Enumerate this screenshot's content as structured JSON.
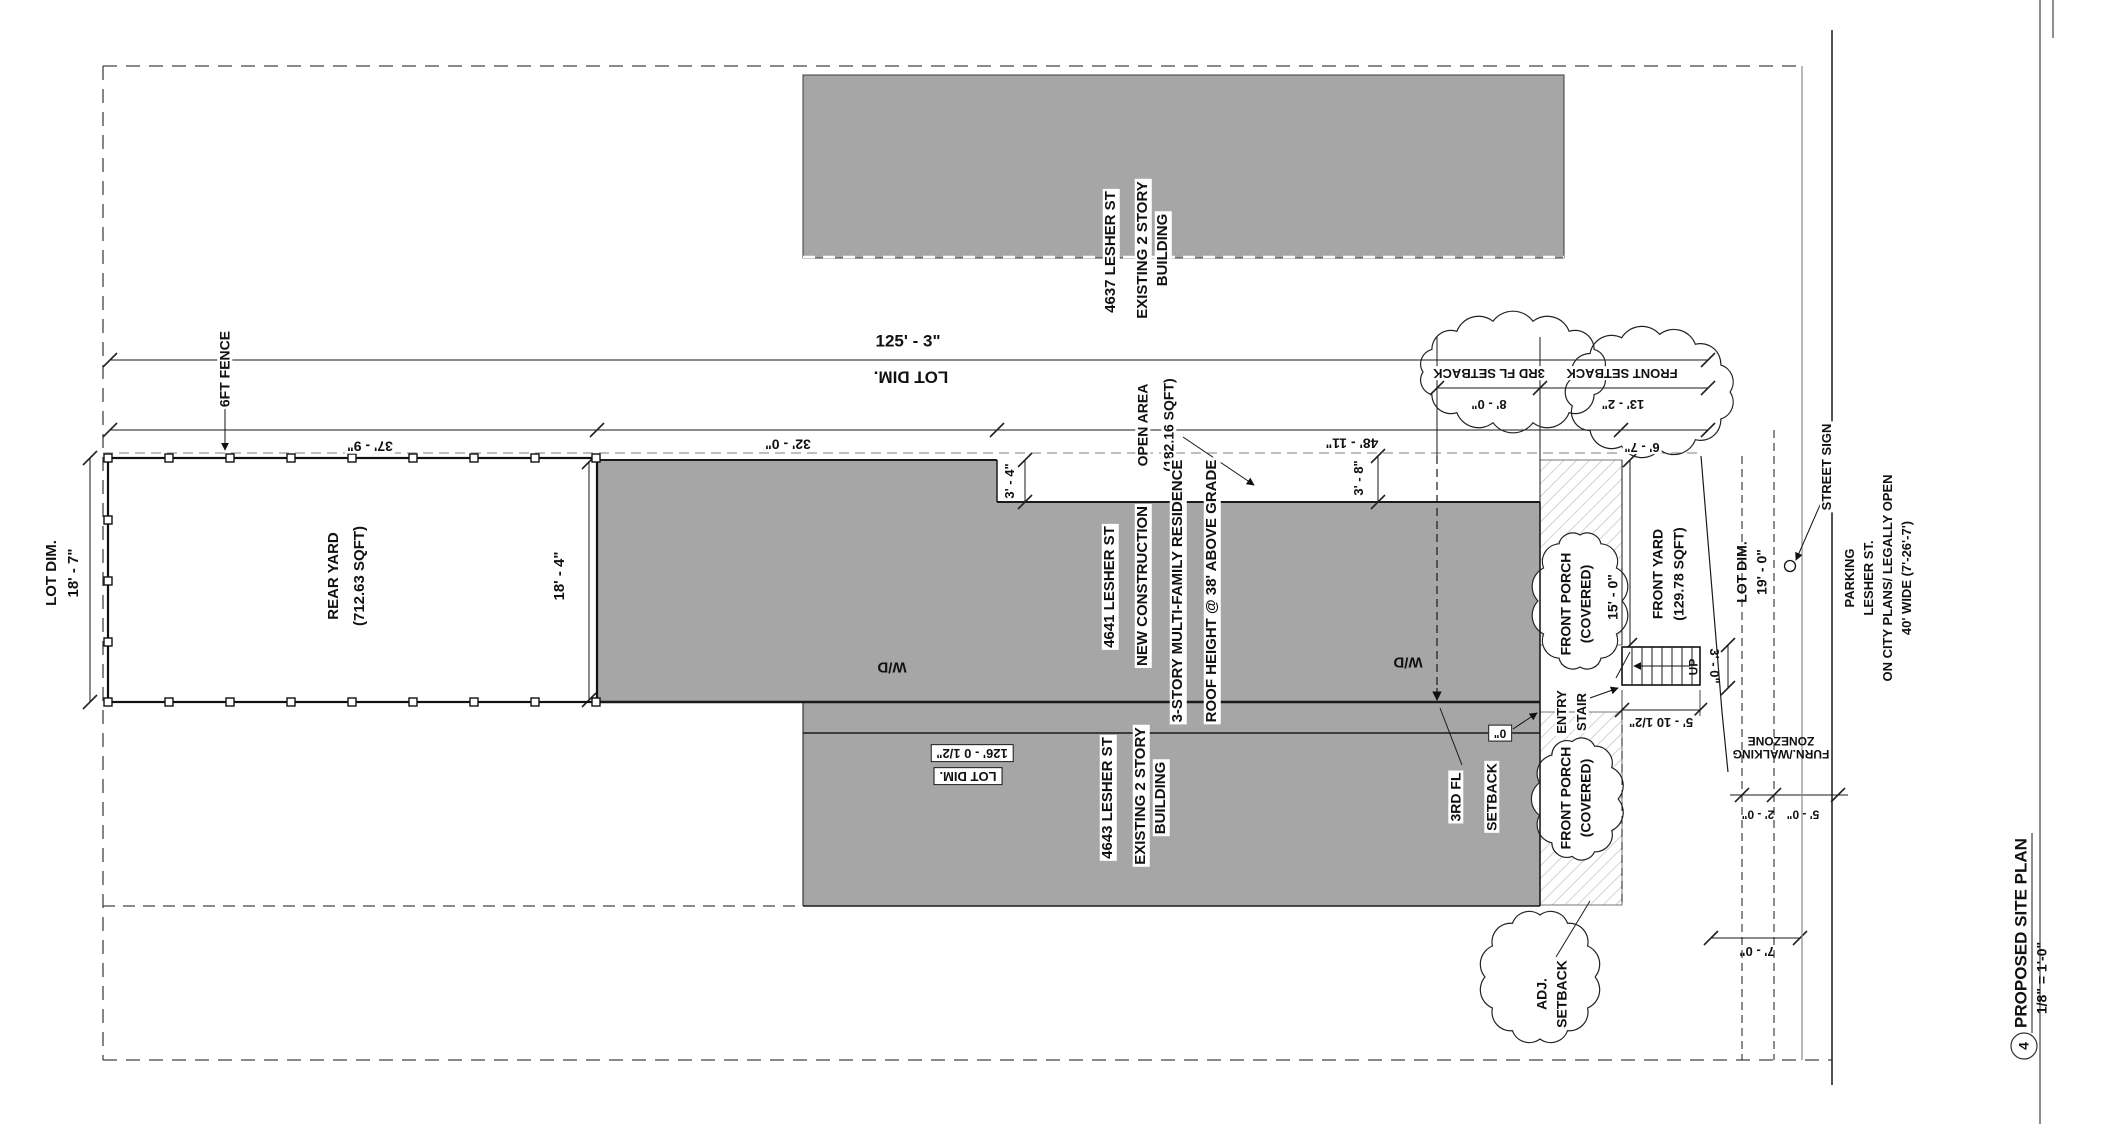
{
  "sheet": {
    "number": "4",
    "title": "PROPOSED SITE PLAN",
    "scale": "1/8\" = 1'-0\""
  },
  "buildings": {
    "top": [
      "4637 LESHER ST",
      "EXISTING 2 STORY",
      "BUILDING"
    ],
    "new": [
      "4641 LESHER ST",
      "NEW CONSTRUCTION",
      "3-STORY MULTI-FAMILY RESIDENCE",
      "ROOF HEIGHT @ 38' ABOVE GRADE"
    ],
    "bottom": [
      "4643 LESHER ST",
      "EXISTING 2 STORY",
      "BUILDING"
    ]
  },
  "areas": {
    "rear_yard": [
      "REAR YARD",
      "(712.63 SQFT)"
    ],
    "open_area": [
      "OPEN AREA",
      "(182.16 SQFT)"
    ],
    "front_yard": [
      "FRONT YARD",
      "(129.78 SQFT)"
    ],
    "front_porch_upper": [
      "FRONT PORCH",
      "(COVERED)"
    ],
    "front_porch_lower": [
      "FRONT PORCH",
      "(COVERED)"
    ]
  },
  "dims": {
    "lot_length_top": "125' - 3\"",
    "lot_dim_top": "LOT DIM.",
    "rear_yard_w": "37' - 9\"",
    "mid_w": "32' - 0\"",
    "front_w": "48' - 11\"",
    "yard_w": "6' - 7\"",
    "notch": "3' - 4\"",
    "side_yard": "3' - 8\"",
    "lot_width_rear": [
      "LOT DIM.",
      "18' - 7\""
    ],
    "rear_depth": "18' - 4\"",
    "front_15": "15' - 0\"",
    "lot_width_front": [
      "LOT DIM.",
      "19' - 0\""
    ],
    "stair_width": "3' - 0\"",
    "stair_len": "5' - 10 1/2\"",
    "zone_2": "2' - 0\"",
    "zone_5": "5' - 0\"",
    "zone_7": "7' - 0\"",
    "lot_length_bottom": [
      "126' - 0 1/2\"",
      "LOT DIM."
    ],
    "zero": "0\""
  },
  "setbacks": {
    "third_fl": {
      "label": "3RD FL SETBACK",
      "value": "8' - 0\""
    },
    "front": {
      "label": "FRONT SETBACK",
      "value": "13' - 2\""
    },
    "third_fl_lower": [
      "3RD FL",
      "SETBACK"
    ],
    "adjacent": [
      "ADJ.",
      "SETBACK"
    ]
  },
  "annotations": {
    "fence": "6FT FENCE",
    "street_sign": "STREET SIGN",
    "parking": [
      "PARKING",
      "LESHER ST.",
      "ON CITY PLANS/ LEGALLY OPEN",
      "40' WIDE (7'-26'-7')"
    ],
    "entry_stair": [
      "ENTRY",
      "STAIR"
    ],
    "up": "UP",
    "wd_left": "W/D",
    "wd_right": "W/D",
    "zone": [
      "FURN./WALKING",
      "ZONEZONE"
    ]
  },
  "colors": {
    "building_fill": "#a6a6a6",
    "line": "#1a1a1a",
    "hatch": "#c0c0c0"
  }
}
